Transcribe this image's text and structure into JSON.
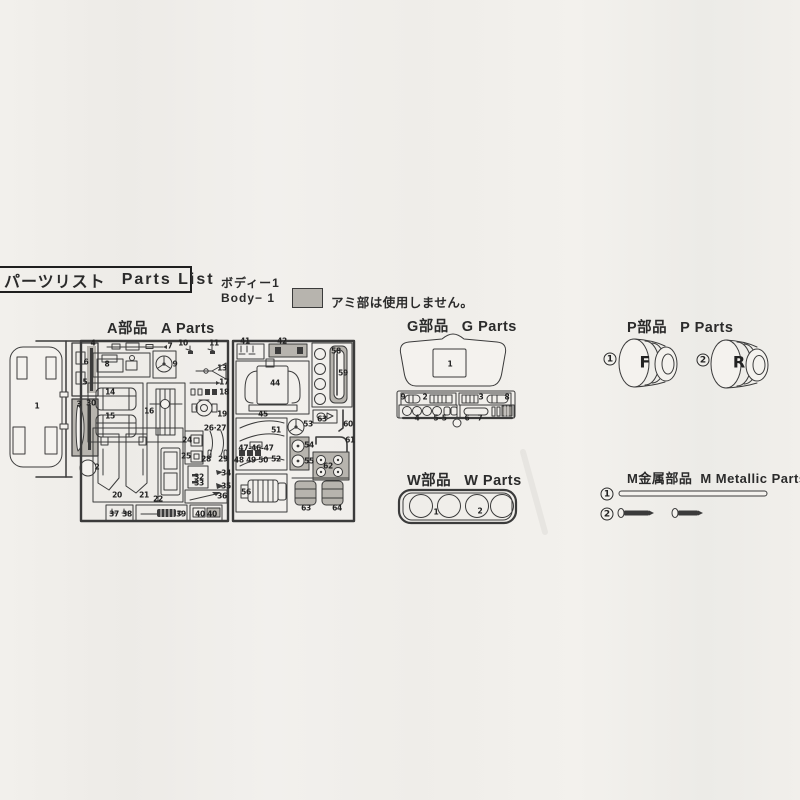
{
  "header": {
    "title_jp": "パーツリスト",
    "title_en": "Parts List"
  },
  "body_note": {
    "jp": "ボディー1",
    "en": "Body− 1",
    "swatch_note": "アミ部は使用しません。"
  },
  "sections": {
    "a": {
      "jp": "A部品",
      "en": "A Parts"
    },
    "g": {
      "jp": "G部品",
      "en": "G Parts"
    },
    "p": {
      "jp": "P部品",
      "en": "P Parts"
    },
    "w": {
      "jp": "W部品",
      "en": "W Parts"
    },
    "m": {
      "jp": "M金属部品",
      "en": "M Metallic Parts"
    }
  },
  "wheel_letters": [
    {
      "t": "F",
      "x": 645,
      "y": 362
    },
    {
      "t": "R",
      "x": 739,
      "y": 362
    }
  ],
  "markers": [
    {
      "t": "1",
      "x": 610,
      "y": 359
    },
    {
      "t": "2",
      "x": 703,
      "y": 360
    },
    {
      "t": "1",
      "x": 607,
      "y": 494
    },
    {
      "t": "2",
      "x": 607,
      "y": 514
    }
  ],
  "part_numbers": [
    {
      "t": "1",
      "x": 37,
      "y": 406
    },
    {
      "t": "4",
      "x": 93,
      "y": 343
    },
    {
      "t": "6",
      "x": 86,
      "y": 362
    },
    {
      "t": "5",
      "x": 85,
      "y": 382
    },
    {
      "t": "3",
      "x": 79,
      "y": 404
    },
    {
      "t": "30",
      "x": 91,
      "y": 403
    },
    {
      "t": "2",
      "x": 97,
      "y": 467
    },
    {
      "t": "7",
      "x": 170,
      "y": 346
    },
    {
      "t": "8",
      "x": 107,
      "y": 364
    },
    {
      "t": "9",
      "x": 175,
      "y": 364
    },
    {
      "t": "10",
      "x": 183,
      "y": 343
    },
    {
      "t": "11",
      "x": 214,
      "y": 343
    },
    {
      "t": "13",
      "x": 222,
      "y": 368
    },
    {
      "t": "14",
      "x": 110,
      "y": 392
    },
    {
      "t": "15",
      "x": 110,
      "y": 416
    },
    {
      "t": "16",
      "x": 149,
      "y": 411
    },
    {
      "t": "17",
      "x": 224,
      "y": 382
    },
    {
      "t": "18",
      "x": 224,
      "y": 392
    },
    {
      "t": "19",
      "x": 222,
      "y": 414
    },
    {
      "t": "26·27",
      "x": 215,
      "y": 428
    },
    {
      "t": "24",
      "x": 187,
      "y": 440
    },
    {
      "t": "25",
      "x": 186,
      "y": 456
    },
    {
      "t": "28",
      "x": 206,
      "y": 459
    },
    {
      "t": "29",
      "x": 223,
      "y": 459
    },
    {
      "t": "20",
      "x": 117,
      "y": 495
    },
    {
      "t": "21",
      "x": 144,
      "y": 495
    },
    {
      "t": "22",
      "x": 158,
      "y": 499
    },
    {
      "t": "32",
      "x": 199,
      "y": 477
    },
    {
      "t": "33",
      "x": 199,
      "y": 483
    },
    {
      "t": "34",
      "x": 226,
      "y": 473
    },
    {
      "t": "35",
      "x": 226,
      "y": 486
    },
    {
      "t": "36",
      "x": 222,
      "y": 496
    },
    {
      "t": "37",
      "x": 114,
      "y": 514
    },
    {
      "t": "38",
      "x": 127,
      "y": 514
    },
    {
      "t": "39",
      "x": 181,
      "y": 514
    },
    {
      "t": "40",
      "x": 200,
      "y": 514
    },
    {
      "t": "40",
      "x": 212,
      "y": 514
    },
    {
      "t": "41",
      "x": 245,
      "y": 341
    },
    {
      "t": "42",
      "x": 282,
      "y": 341
    },
    {
      "t": "44",
      "x": 275,
      "y": 383
    },
    {
      "t": "58",
      "x": 336,
      "y": 351
    },
    {
      "t": "59",
      "x": 343,
      "y": 373
    },
    {
      "t": "45",
      "x": 263,
      "y": 414
    },
    {
      "t": "51",
      "x": 276,
      "y": 430
    },
    {
      "t": "53",
      "x": 308,
      "y": 424
    },
    {
      "t": "63",
      "x": 322,
      "y": 419
    },
    {
      "t": "60",
      "x": 348,
      "y": 424
    },
    {
      "t": "61",
      "x": 350,
      "y": 440
    },
    {
      "t": "47-46-47",
      "x": 256,
      "y": 448
    },
    {
      "t": "48 49 50",
      "x": 251,
      "y": 460
    },
    {
      "t": "52",
      "x": 276,
      "y": 459
    },
    {
      "t": "54",
      "x": 309,
      "y": 445
    },
    {
      "t": "55",
      "x": 309,
      "y": 461
    },
    {
      "t": "62",
      "x": 328,
      "y": 466
    },
    {
      "t": "56",
      "x": 246,
      "y": 492
    },
    {
      "t": "63",
      "x": 306,
      "y": 508
    },
    {
      "t": "64",
      "x": 337,
      "y": 508
    },
    {
      "t": "1",
      "x": 450,
      "y": 364
    },
    {
      "t": "9",
      "x": 403,
      "y": 397
    },
    {
      "t": "2",
      "x": 425,
      "y": 397
    },
    {
      "t": "3",
      "x": 481,
      "y": 397
    },
    {
      "t": "8",
      "x": 507,
      "y": 397
    },
    {
      "t": "4",
      "x": 417,
      "y": 418
    },
    {
      "t": "5–5",
      "x": 440,
      "y": 418
    },
    {
      "t": "6",
      "x": 467,
      "y": 418
    },
    {
      "t": "7",
      "x": 480,
      "y": 418
    },
    {
      "t": "1",
      "x": 436,
      "y": 512
    },
    {
      "t": "2",
      "x": 480,
      "y": 511
    }
  ],
  "colors": {
    "paper": "#f1efeb",
    "ink": "#2b2b2b",
    "shade": "#b7b4ae"
  }
}
